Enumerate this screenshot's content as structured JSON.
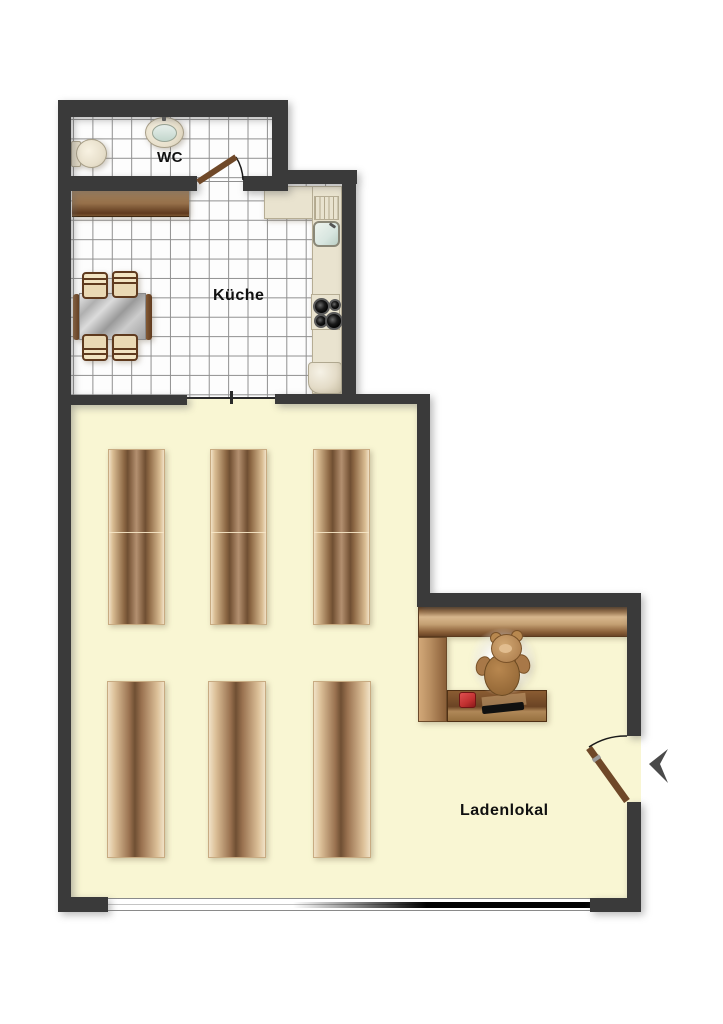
{
  "floorplan": {
    "rooms": {
      "wc": {
        "label": "WC"
      },
      "kitchen": {
        "label": "Küche"
      },
      "shop": {
        "label": "Ladenlokal"
      }
    },
    "colors": {
      "wall": "#3a3a3a",
      "shop_floor": "#f9f6d3",
      "tile_floor": "#fdfdfd",
      "tile_line": "#909090",
      "counter_beige": "#e9e3cf",
      "wood_light": "#d9b88e",
      "wood_dark": "#6b4526",
      "register_red": "#c03030",
      "sink_blue": "#d8e6e0",
      "door_wood": "#6f4828",
      "entry_arrow": "#4a4a4a"
    },
    "fixtures": [
      "toilet",
      "wash-basin",
      "wc-door",
      "kitchen-sideboard",
      "dining-table",
      "four-chairs",
      "kitchen-counter",
      "kitchen-sink",
      "stove-4-burners",
      "fridge",
      "shelf-units-row1-x3",
      "shelf-units-row2-x3",
      "wall-shelf",
      "sales-counter",
      "cash-register",
      "scanner",
      "teddy-bear",
      "entry-door",
      "entry-arrow",
      "shop-window"
    ]
  }
}
